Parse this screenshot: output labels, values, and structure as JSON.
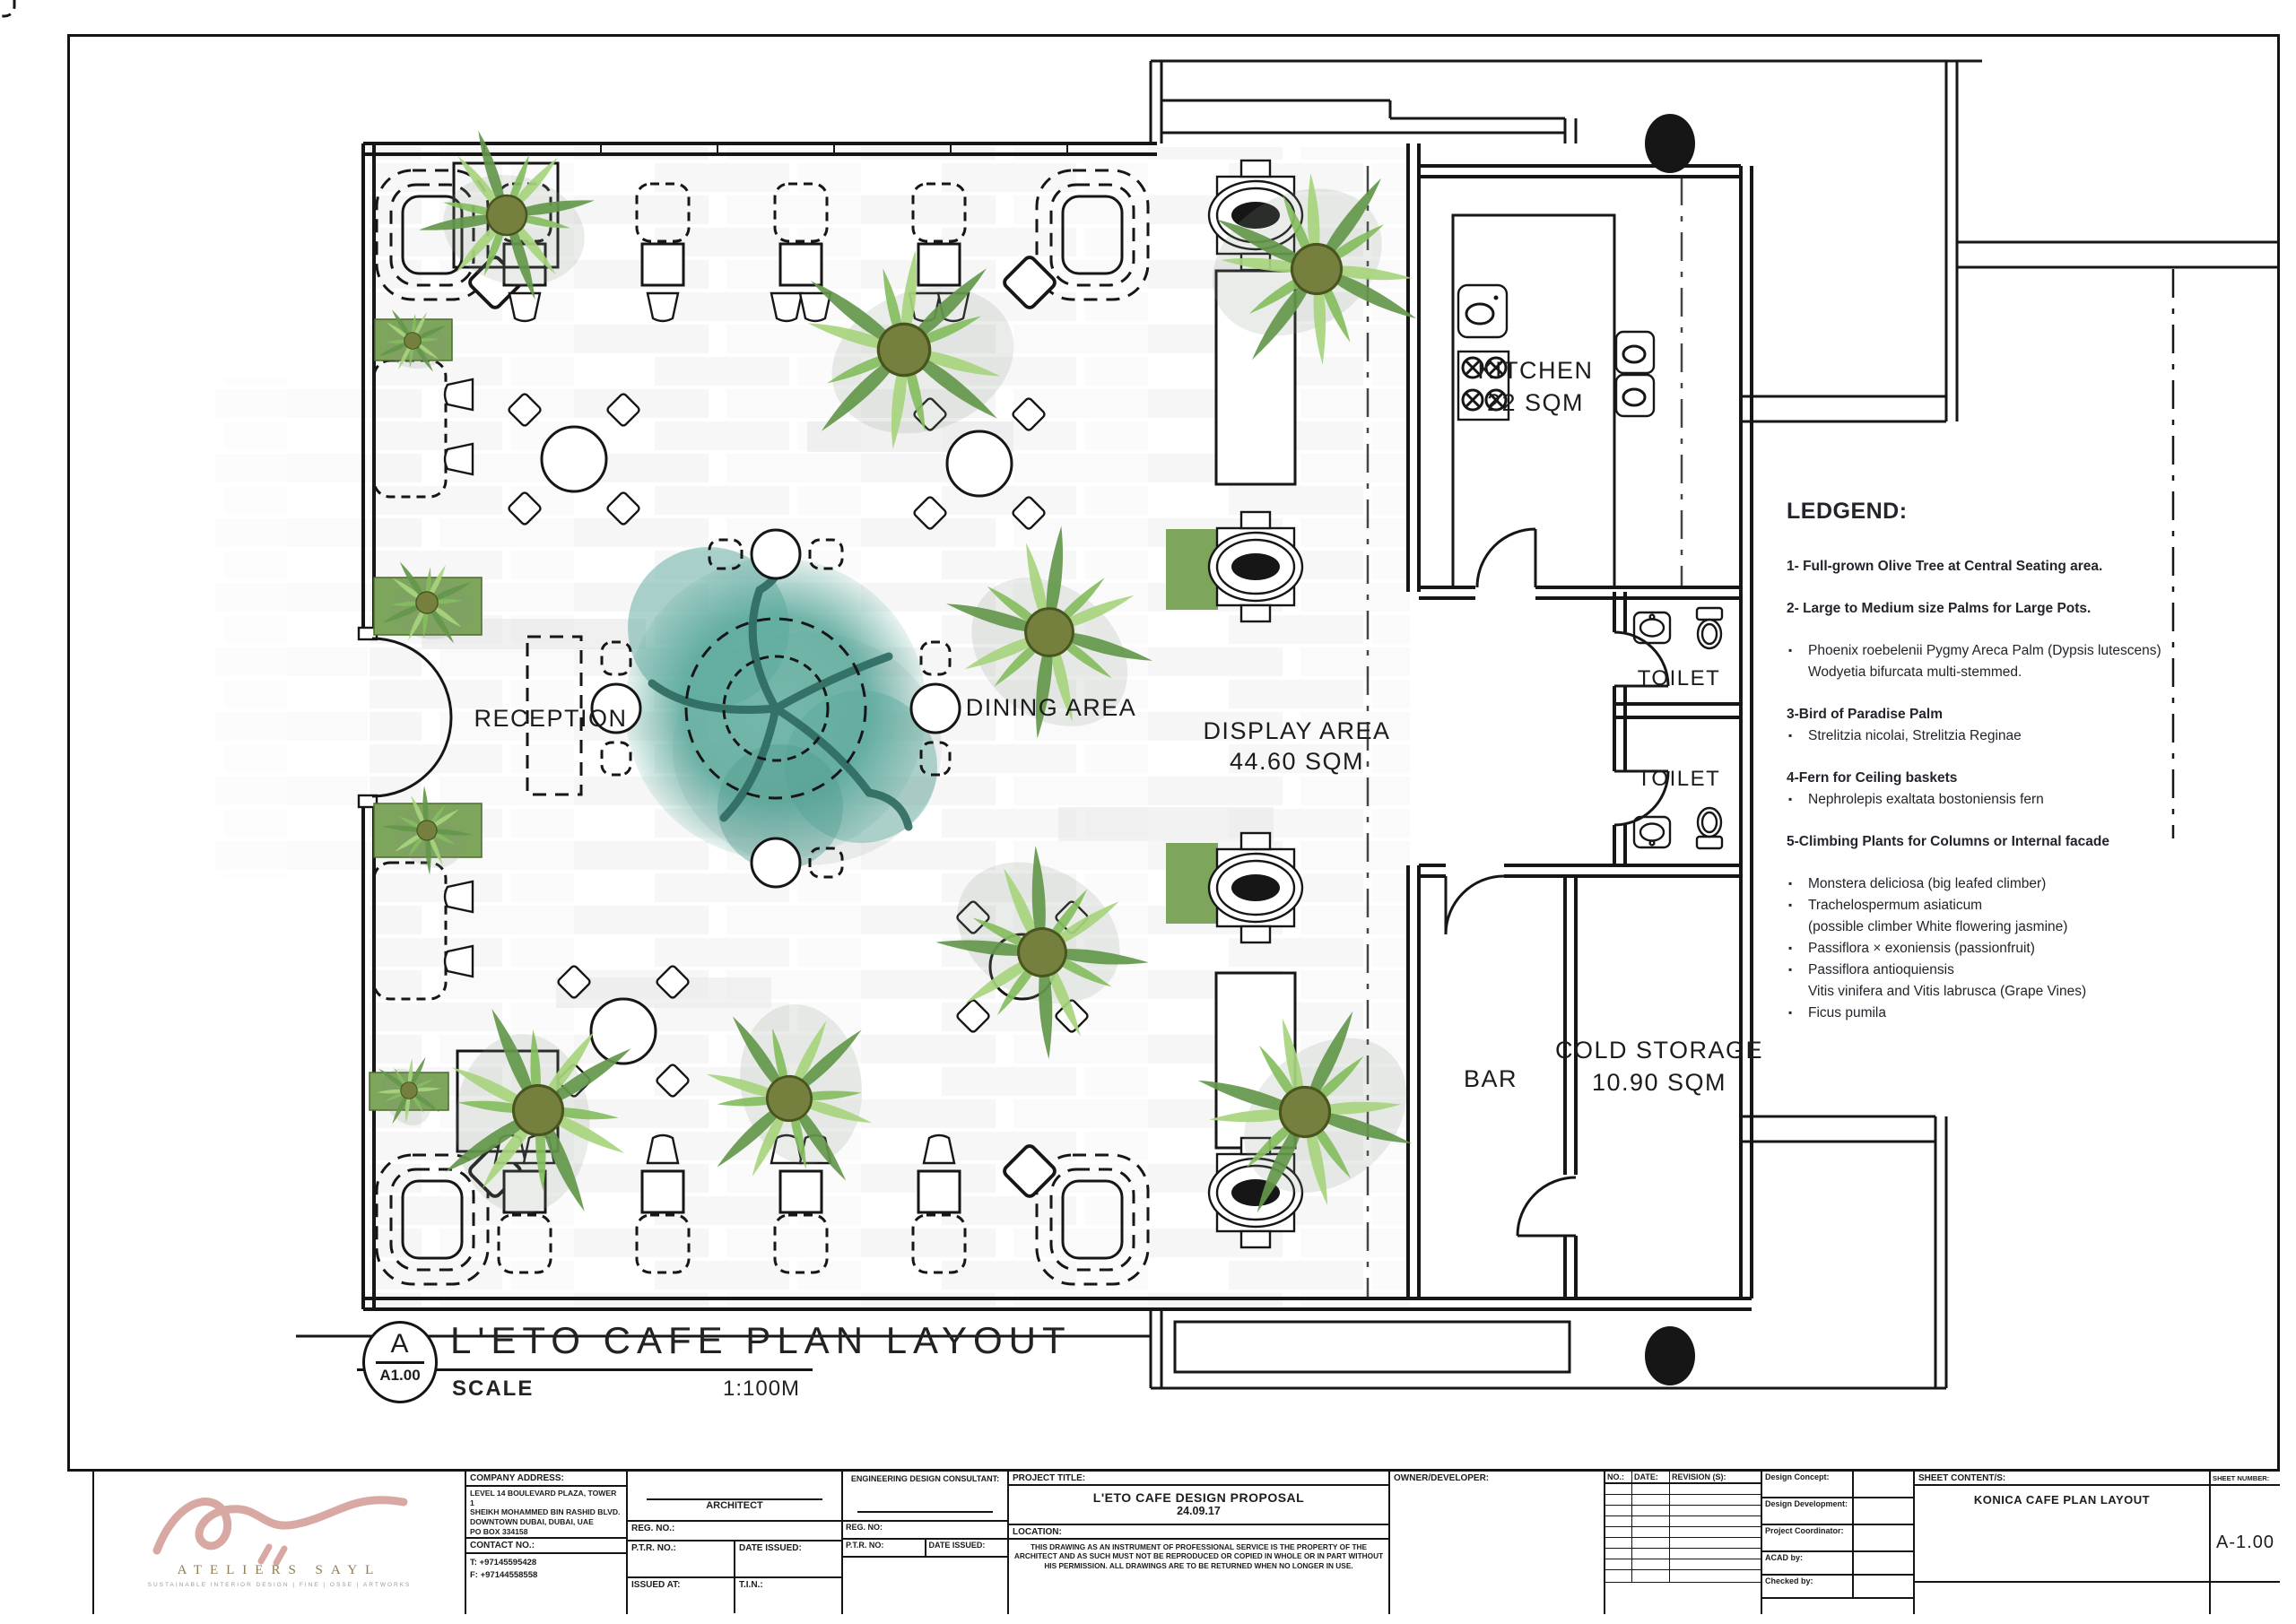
{
  "plan": {
    "labels": {
      "reception": "RECEPTION",
      "dining_area": "DINING AREA",
      "display_area": "DISPLAY AREA",
      "display_area_size": "44.60 SQM",
      "kitchen": "KITCHEN",
      "kitchen_size": "22 SQM",
      "toilet_1": "TOILET",
      "toilet_2": "TOILET",
      "bar": "BAR",
      "cold_storage": "COLD STORAGE",
      "cold_storage_size": "10.90 SQM"
    },
    "drawing_title": {
      "detail_letter": "A",
      "detail_sheet": "A1.00",
      "title": "L'ETO CAFE PLAN LAYOUT",
      "scale_label": "SCALE",
      "scale_value": "1:100M"
    }
  },
  "legend": {
    "title": "LEDGEND:",
    "item1": "1- Full-grown Olive Tree at Central Seating area.",
    "item2": "2- Large to Medium size Palms for Large Pots.",
    "item2a": "Phoenix roebelenii Pygmy Areca Palm (Dypsis lutescens)",
    "item2b": "Wodyetia bifurcata multi-stemmed.",
    "item3": "3-Bird of Paradise Palm",
    "item3a": "Strelitzia nicolai, Strelitzia Reginae",
    "item4": "4-Fern for Ceiling baskets",
    "item4a": "Nephrolepis exaltata bostoniensis fern",
    "item5": "5-Climbing Plants for Columns or Internal facade",
    "item5a": "Monstera deliciosa (big leafed climber)",
    "item5b": "Trachelospermum asiaticum",
    "item5b2": "(possible climber White flowering jasmine)",
    "item5c": "Passiflora × exoniensis (passionfruit)",
    "item5d": "Passiflora antioquiensis",
    "item5d2": "Vitis vinifera and Vitis labrusca (Grape Vines)",
    "item5e": "Ficus pumila"
  },
  "titleblock": {
    "logo": {
      "brand": "ATELIERS SAYL",
      "tagline": "SUSTAINABLE INTERIOR DESIGN   |   FINE   |   OSSE   |   ARTWORKS"
    },
    "company": {
      "address_label": "COMPANY ADDRESS:",
      "address1": "LEVEL 14 BOULEVARD PLAZA, TOWER 1",
      "address2": "SHEIKH MOHAMMED BIN RASHID BLVD.",
      "address3": "DOWNTOWN DUBAI, DUBAI, UAE",
      "address4": "PO BOX 334158",
      "contact_label": "CONTACT NO.:",
      "tel": "T: +97145595428",
      "fax": "F: +97144558558"
    },
    "architect": {
      "title": "ARCHITECT",
      "reg_no": "REG. NO.:",
      "ptr_no": "P.T.R. NO.:",
      "date_issued": "DATE ISSUED:",
      "issued_at": "ISSUED AT:",
      "tin": "T.I.N.:"
    },
    "consultant": {
      "title": "ENGINEERING DESIGN CONSULTANT:",
      "reg_no": "REG. NO:",
      "ptr_no": "P.T.R. NO:",
      "date_issued": "DATE ISSUED:"
    },
    "project": {
      "label": "PROJECT TITLE:",
      "title": "L'ETO CAFE DESIGN PROPOSAL",
      "date": "24.09.17",
      "location_label": "LOCATION:",
      "disclaimer": "THIS DRAWING AS AN INSTRUMENT OF PROFESSIONAL SERVICE IS THE PROPERTY OF THE ARCHITECT AND AS SUCH MUST NOT BE REPRODUCED OR COPIED IN WHOLE OR IN PART WITHOUT HIS PERMISSION.  ALL DRAWINGS ARE TO BE RETURNED WHEN NO LONGER IN USE."
    },
    "owner": {
      "label": "OWNER/DEVELOPER:"
    },
    "revision": {
      "no": "NO.:",
      "date": "DATE:",
      "revisions": "REVISION (S):"
    },
    "roles": {
      "r1": "Design Concept:",
      "r2": "Design Development:",
      "r3": "Project Coordinator:",
      "r4": "ACAD by:",
      "r5": "Checked by:"
    },
    "sheet": {
      "content_label": "SHEET CONTENT/S:",
      "content": "KONICA CAFE PLAN LAYOUT",
      "number_label": "SHEET NUMBER:",
      "number": "A-1.00"
    }
  },
  "colors": {
    "line": "#161616",
    "olive_tree_teal": "#58a89a",
    "palm_green": "#84bd5e",
    "planter_green": "#7da55b",
    "logo_pink": "#d8a8a2"
  }
}
